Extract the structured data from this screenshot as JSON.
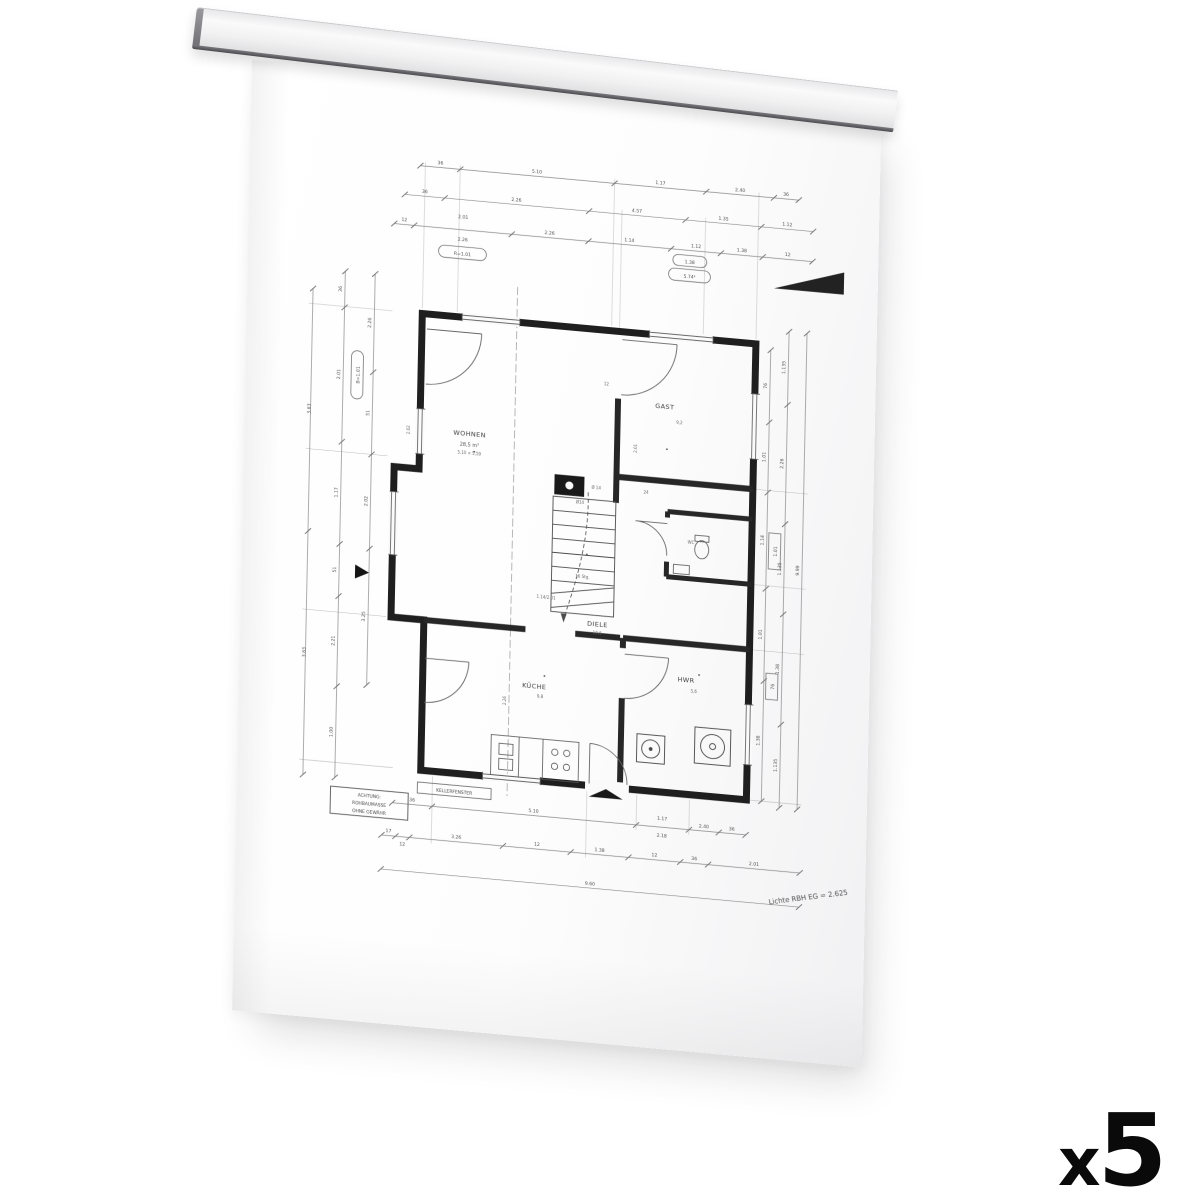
{
  "overlay": {
    "quantity_prefix": "x",
    "quantity_value": "5"
  },
  "drawing": {
    "rooms": {
      "wohnen": {
        "name": "WOHNEN",
        "area": "28,5 m²",
        "size": "5,10 × 5,59"
      },
      "gast": {
        "name": "GAST",
        "area": "9,2"
      },
      "diele": {
        "name": "DIELE",
        "area": "10,6"
      },
      "kueche": {
        "name": "KÜCHE",
        "area": "9,8"
      },
      "hwr": {
        "name": "HWR",
        "area": "5,6"
      },
      "wc": {
        "name": "WC"
      }
    },
    "stair_label": "16 Stg.",
    "chimney_label": "Ø 14",
    "notes": {
      "attention": [
        "ACHTUNG:",
        "ROHBAUMASSE",
        "OHNE GEWÄHR"
      ],
      "window_label": "KELLERFENSTER",
      "height_note": "Lichte RBH EG = 2.625"
    },
    "dims": {
      "top1": [
        "36",
        "5.10",
        "1.17",
        "2.40",
        "36"
      ],
      "top2": [
        "36",
        "2.26",
        "4.57",
        "1.35",
        "1.12"
      ],
      "top3": [
        "12",
        "18",
        "2.26",
        "1.14",
        "1.12",
        "1.38",
        "12"
      ],
      "top_stack": [
        "2.01",
        "2.26"
      ],
      "top_oval1": "R=1.01",
      "top_oval2": [
        "1.38",
        "5.74²"
      ],
      "bottom1": [
        "36",
        "5.10",
        "2.40",
        "36"
      ],
      "bottom1_stack": [
        "1.17",
        "2.18"
      ],
      "bottom2": [
        "17",
        "12",
        "3.26",
        "12",
        "1.38",
        "12",
        "36",
        "2.01"
      ],
      "bottom_total": "9.60",
      "left1": [
        "3.63",
        "3.63"
      ],
      "left2": [
        "36",
        "2.01",
        "1.17",
        "51",
        "2.21",
        "1.00"
      ],
      "left3": [
        "2.26",
        "51",
        "2.02",
        "3.25"
      ],
      "left_oval": "B=1.01",
      "right1": [
        "76",
        "1.01",
        "1.14",
        "1.01",
        "1.38"
      ],
      "right_boxes": [
        "1.01",
        "76"
      ],
      "right2": [
        "1.135",
        "2.26",
        "1.135",
        "1.38",
        "1.135"
      ],
      "right_total": "9.99",
      "marks": [
        "2.02",
        "Ø14",
        "12",
        "2.01",
        "1.14/2.01",
        "24",
        "2.26"
      ]
    }
  }
}
